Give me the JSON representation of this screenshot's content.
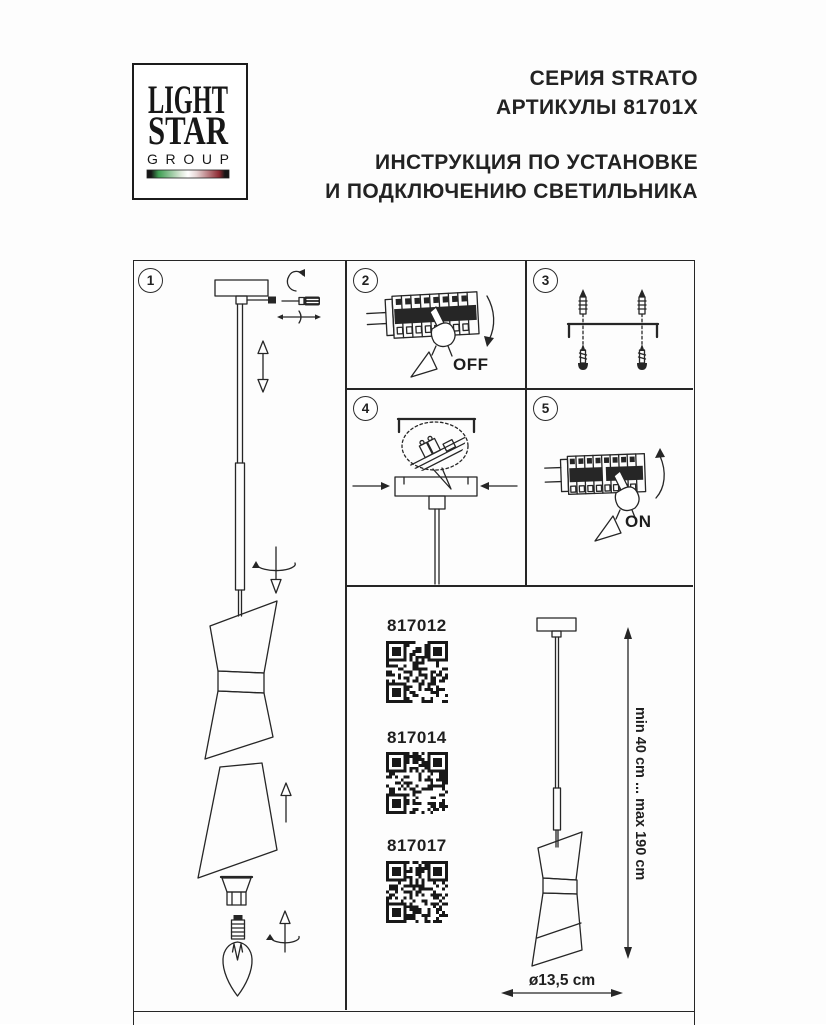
{
  "logo": {
    "line1": "LIGHT",
    "line2": "STAR",
    "line3": "GROUP"
  },
  "header": {
    "series": "СЕРИЯ STRATO",
    "articles": "АРТИКУЛЫ 81701X",
    "instruction_line1": "ИНСТРУКЦИЯ ПО УСТАНОВКЕ",
    "instruction_line2": "И ПОДКЛЮЧЕНИЮ СВЕТИЛЬНИКА"
  },
  "panels": {
    "step1": {
      "number": "1",
      "icon": "pendant-exploded-assembly-diagram"
    },
    "step2": {
      "number": "2",
      "icon": "circuit-breaker-switch-off-diagram",
      "label": "OFF"
    },
    "step3": {
      "number": "3",
      "icon": "bracket-wall-plugs-screws-diagram"
    },
    "step4": {
      "number": "4",
      "icon": "canopy-mounting-terminal-block-diagram"
    },
    "step5": {
      "number": "5",
      "icon": "circuit-breaker-switch-on-diagram",
      "label": "ON"
    }
  },
  "products": [
    {
      "article": "817012"
    },
    {
      "article": "817014"
    },
    {
      "article": "817017"
    }
  ],
  "dimensions": {
    "height_range": "min 40 cm ... max 190 cm",
    "diameter": "ø13,5 cm"
  },
  "colors": {
    "ink": "#262626",
    "flag_green": "#3f9e53",
    "flag_red": "#8e2b33",
    "background": "#fdfdfd"
  }
}
